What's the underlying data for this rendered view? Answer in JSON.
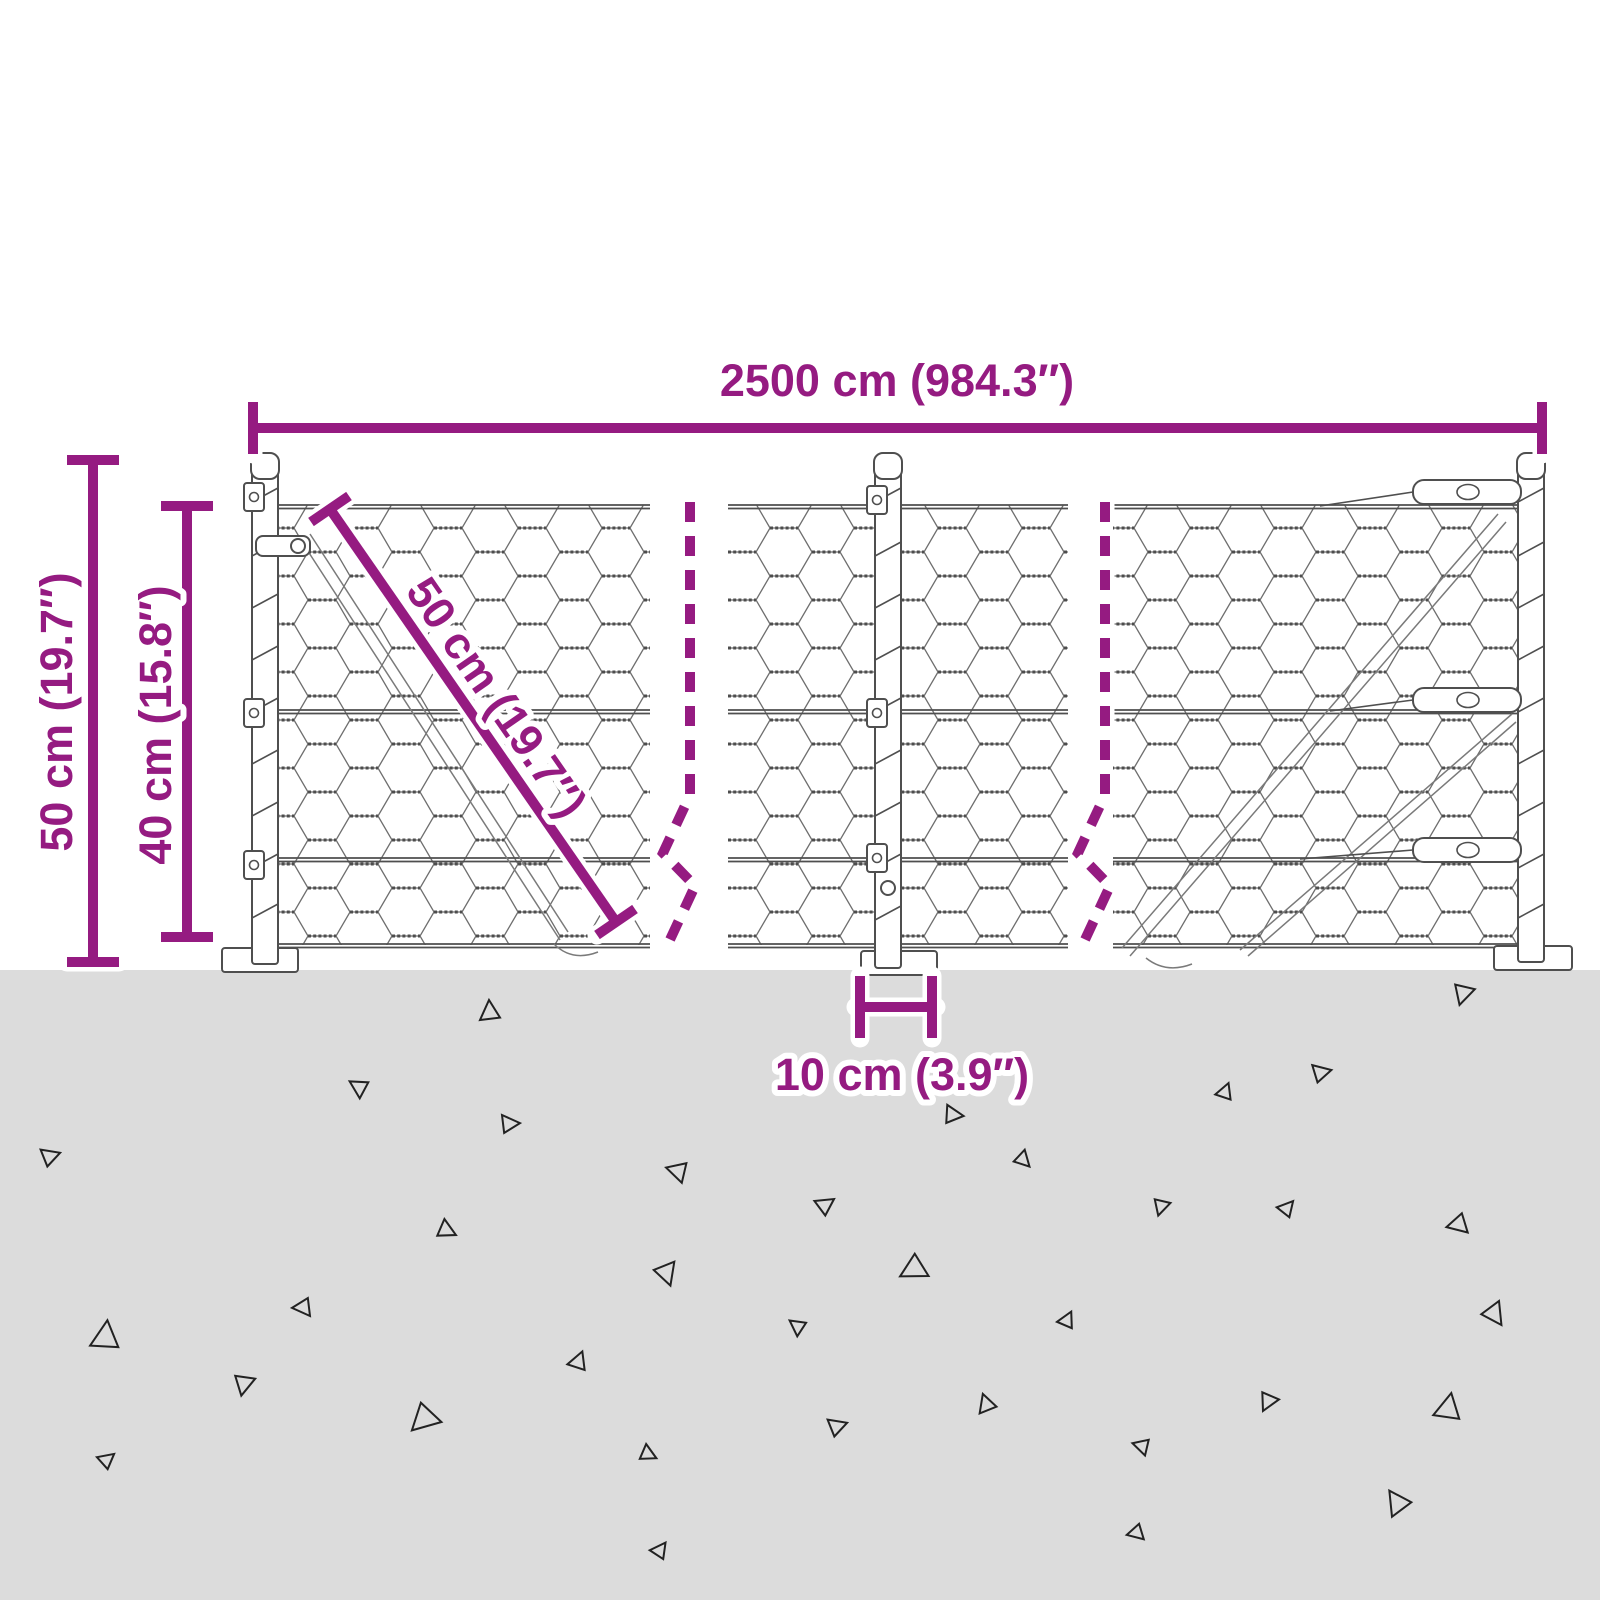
{
  "diagram": {
    "type": "product-dimension-diagram",
    "subject": "wire-mesh-fence-with-posts",
    "dimensions": {
      "total_width": "2500 cm (984.3″)",
      "post_height": "50 cm (19.7″)",
      "mesh_height": "40 cm (15.8″)",
      "mesh_diagonal": "50 cm (19.7″)",
      "base_width": "10 cm (3.9″)"
    },
    "colors": {
      "accent": "#951b81",
      "ground": "#dcdcdc",
      "triangle": "#222222",
      "line": "#4f4f4f",
      "background": "#ffffff"
    },
    "ground": {
      "triangles": [
        {
          "x": 480,
          "y": 1000,
          "s": 20,
          "r": 0
        },
        {
          "x": 1468,
          "y": 1008,
          "s": 20,
          "r": 200
        },
        {
          "x": 345,
          "y": 1088,
          "s": 18,
          "r": 305
        },
        {
          "x": 1330,
          "y": 1062,
          "s": 18,
          "r": 80
        },
        {
          "x": 1222,
          "y": 1080,
          "s": 16,
          "r": 25
        },
        {
          "x": 965,
          "y": 1108,
          "s": 18,
          "r": 100
        },
        {
          "x": 520,
          "y": 1115,
          "s": 18,
          "r": 90
        },
        {
          "x": 58,
          "y": 1145,
          "s": 18,
          "r": 75
        },
        {
          "x": 1035,
          "y": 1162,
          "s": 16,
          "r": 140
        },
        {
          "x": 663,
          "y": 1176,
          "s": 20,
          "r": 290
        },
        {
          "x": 830,
          "y": 1192,
          "s": 18,
          "r": 60
        },
        {
          "x": 1288,
          "y": 1196,
          "s": 16,
          "r": 45
        },
        {
          "x": 1165,
          "y": 1218,
          "s": 16,
          "r": 200
        },
        {
          "x": 460,
          "y": 1228,
          "s": 18,
          "r": 120
        },
        {
          "x": 1448,
          "y": 1236,
          "s": 20,
          "r": 260
        },
        {
          "x": 95,
          "y": 1318,
          "s": 28,
          "r": 10
        },
        {
          "x": 292,
          "y": 1316,
          "s": 18,
          "r": 270
        },
        {
          "x": 680,
          "y": 1283,
          "s": 22,
          "r": 165
        },
        {
          "x": 905,
          "y": 1287,
          "s": 26,
          "r": 245
        },
        {
          "x": 1065,
          "y": 1308,
          "s": 16,
          "r": 30
        },
        {
          "x": 785,
          "y": 1326,
          "s": 16,
          "r": 310
        },
        {
          "x": 575,
          "y": 1348,
          "s": 18,
          "r": 25
        },
        {
          "x": 1510,
          "y": 1320,
          "s": 22,
          "r": 150
        },
        {
          "x": 250,
          "y": 1398,
          "s": 20,
          "r": 195
        },
        {
          "x": 975,
          "y": 1396,
          "s": 18,
          "r": 345
        },
        {
          "x": 1440,
          "y": 1390,
          "s": 26,
          "r": 15
        },
        {
          "x": 110,
          "y": 1448,
          "s": 16,
          "r": 55
        },
        {
          "x": 420,
          "y": 1440,
          "s": 28,
          "r": 230
        },
        {
          "x": 660,
          "y": 1452,
          "s": 16,
          "r": 120
        },
        {
          "x": 845,
          "y": 1415,
          "s": 18,
          "r": 75
        },
        {
          "x": 1130,
          "y": 1450,
          "s": 16,
          "r": 290
        },
        {
          "x": 1270,
          "y": 1415,
          "s": 18,
          "r": 210
        },
        {
          "x": 1380,
          "y": 1496,
          "s": 24,
          "r": 330
        },
        {
          "x": 660,
          "y": 1538,
          "s": 16,
          "r": 40
        },
        {
          "x": 1128,
          "y": 1542,
          "s": 16,
          "r": 260
        }
      ]
    }
  }
}
